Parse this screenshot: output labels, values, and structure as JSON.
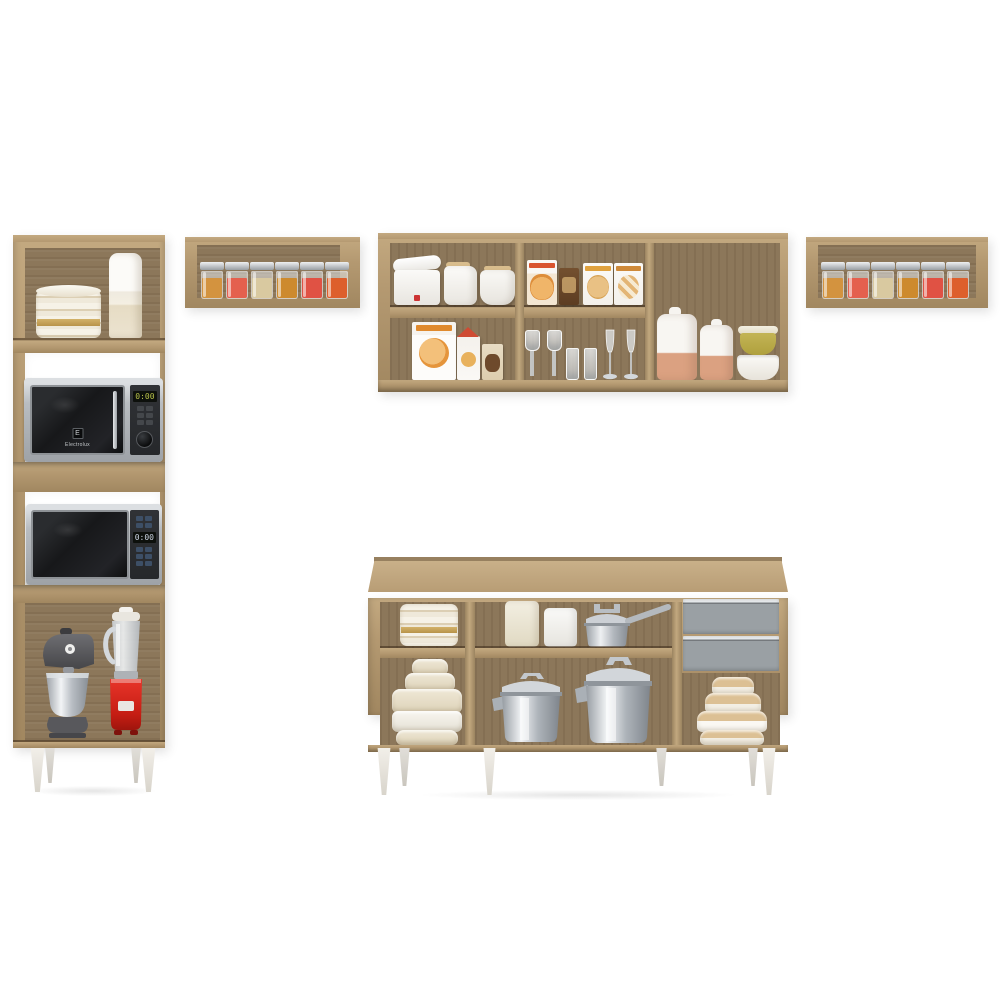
{
  "palette": {
    "bg": "#ffffff",
    "wood": "#b49971",
    "wood_light": "#c3a980",
    "wood_mid": "#a18760",
    "wood_back": "#8c775a",
    "leg_white": "#f2efe9",
    "leg_shadow": "#d8d4cb",
    "drawer_gray": "#9aa0a4",
    "mw_silver": "#b9bdc1",
    "mw_dark": "#17181a",
    "mw_panel": "#26282b",
    "display_green": "#b8c24a",
    "red": "#d6241b",
    "terracotta": "#dba181",
    "olive": "#afa03d",
    "steel": "#c9cdd2"
  },
  "tower": {
    "top_shelf_items": [
      "stacked-plates",
      "storage-canister"
    ],
    "microwave_top": {
      "brand": "Electrolux",
      "logo": "E",
      "display": "0:00"
    },
    "microwave_bottom": {
      "display": "0:00"
    },
    "bottom_items": [
      "stand-mixer",
      "blender"
    ]
  },
  "spice_shelf_left": {
    "jars": [
      {
        "name": "spice-jar",
        "color": "#d3933f"
      },
      {
        "name": "spice-jar",
        "color": "#e4604e"
      },
      {
        "name": "spice-jar",
        "color": "#d9c9a0"
      },
      {
        "name": "spice-jar",
        "color": "#cd8a2e"
      },
      {
        "name": "spice-jar",
        "color": "#e05244"
      },
      {
        "name": "spice-jar",
        "color": "#dd5f2c"
      }
    ]
  },
  "spice_shelf_right": {
    "jars": [
      {
        "name": "spice-jar",
        "color": "#d3933f"
      },
      {
        "name": "spice-jar",
        "color": "#e4604e"
      },
      {
        "name": "spice-jar",
        "color": "#d9c9a0"
      },
      {
        "name": "spice-jar",
        "color": "#cd8a2e"
      },
      {
        "name": "spice-jar",
        "color": "#e05244"
      },
      {
        "name": "spice-jar",
        "color": "#dd5f2c"
      }
    ]
  },
  "wall_cabinet": {
    "left_top_items": [
      "kitchen-scale",
      "milk-jug",
      "lidded-canister"
    ],
    "left_bottom_items": [
      "pizza-box",
      "milk-carton",
      "snack-box"
    ],
    "middle_top_items": [
      "cereal-box",
      "cocoa-box",
      "cookie-box",
      "cookie-box"
    ],
    "middle_bottom_items": [
      "stem-glasses",
      "tumblers",
      "champagne-flutes"
    ],
    "right_items": [
      "ceramic-canister",
      "ceramic-canister",
      "olive-bowl",
      "white-bowl"
    ]
  },
  "counter": {
    "left_top_item": "stacked-plates",
    "left_bottom_item": "tiered-bowl-stack",
    "middle_top_items": [
      "ivory-canister",
      "white-canister",
      "saucepan"
    ],
    "middle_bottom_items": [
      "stock-pot-small",
      "stock-pot-large"
    ],
    "drawer_count": "2",
    "right_bottom_item": "wood-lid-bowl-stack"
  }
}
